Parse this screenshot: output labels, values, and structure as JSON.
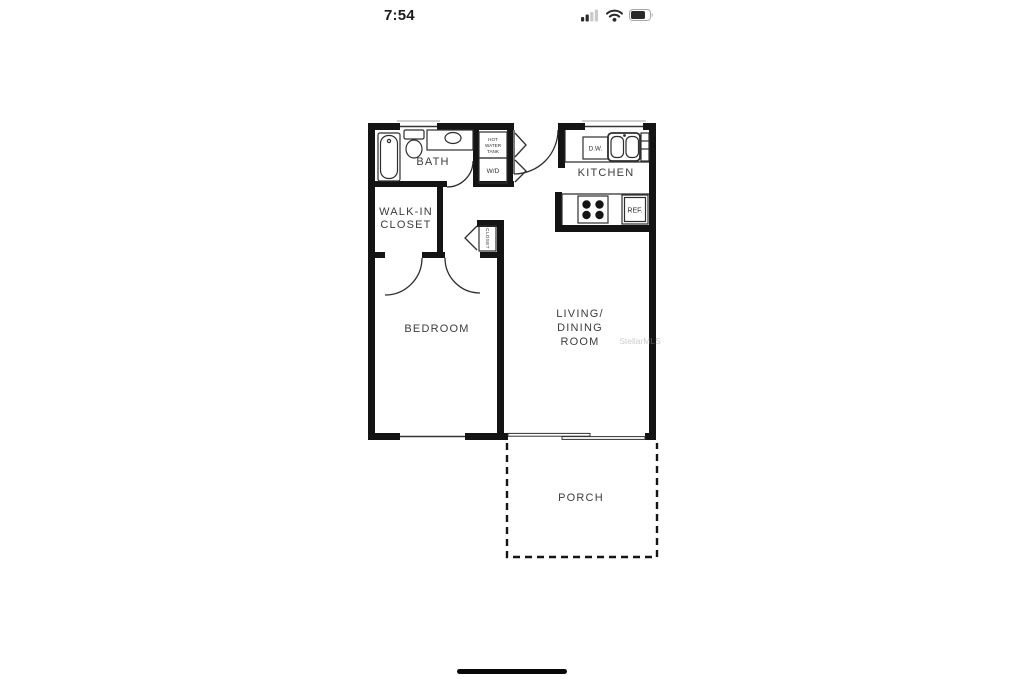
{
  "status_bar": {
    "time": "7:54"
  },
  "floor_plan": {
    "labels": {
      "bath": "BATH",
      "walk_in_closet_l1": "WALK-IN",
      "walk_in_closet_l2": "CLOSET",
      "hall_closet": "CLOSET",
      "kitchen": "KITCHEN",
      "bedroom": "BEDROOM",
      "living_l1": "LIVING/",
      "living_l2": "DINING",
      "living_l3": "ROOM",
      "porch": "PORCH"
    },
    "fixtures": {
      "hot_water_tank_l1": "HOT",
      "hot_water_tank_l2": "WATER",
      "hot_water_tank_l3": "TANK",
      "washer_dryer": "W/D",
      "dishwasher": "D.W.",
      "refrigerator": "REF."
    },
    "watermark": "StellarMLS",
    "colors": {
      "wall": "#141414",
      "fixture_line": "#2e2e2e",
      "label": "#3c3c3c",
      "watermark": "#9a9a9a"
    }
  }
}
